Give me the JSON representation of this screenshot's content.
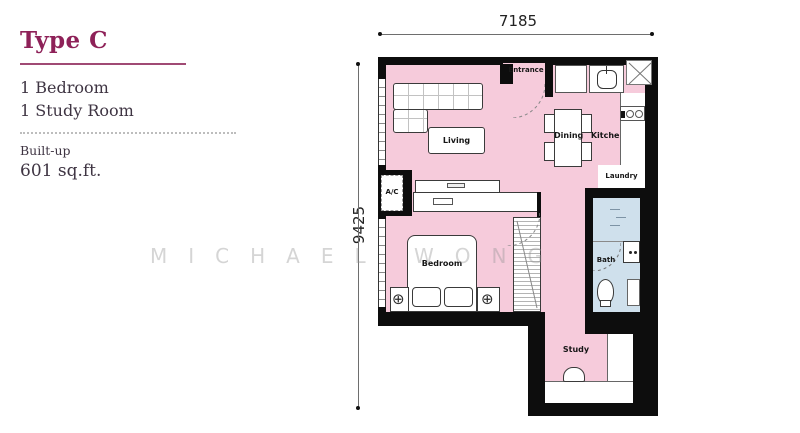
{
  "info_panel": {
    "title": "Type C",
    "features": [
      "1 Bedroom",
      "1 Study Room"
    ],
    "built_up_label": "Built-up",
    "built_up_value": "601 sq.ft.",
    "accent_color": "#8e2158"
  },
  "floor_plan": {
    "dimensions": {
      "width": "7185",
      "height": "9425"
    },
    "labels": {
      "entrance": "Entrance",
      "living": "Living",
      "dining": "Dining",
      "kitchen": "Kitchen",
      "laundry": "Laundry",
      "ac": "A/C",
      "bedroom": "Bedroom",
      "bath": "Bath",
      "study": "Study"
    },
    "icons": {
      "lamp": "⊕"
    },
    "colors": {
      "floor": "#f6cbdb",
      "bath_floor": "#cfe0ec",
      "wall": "#0d0d0d"
    }
  },
  "watermark": {
    "text": "MICHAEL WONG"
  }
}
